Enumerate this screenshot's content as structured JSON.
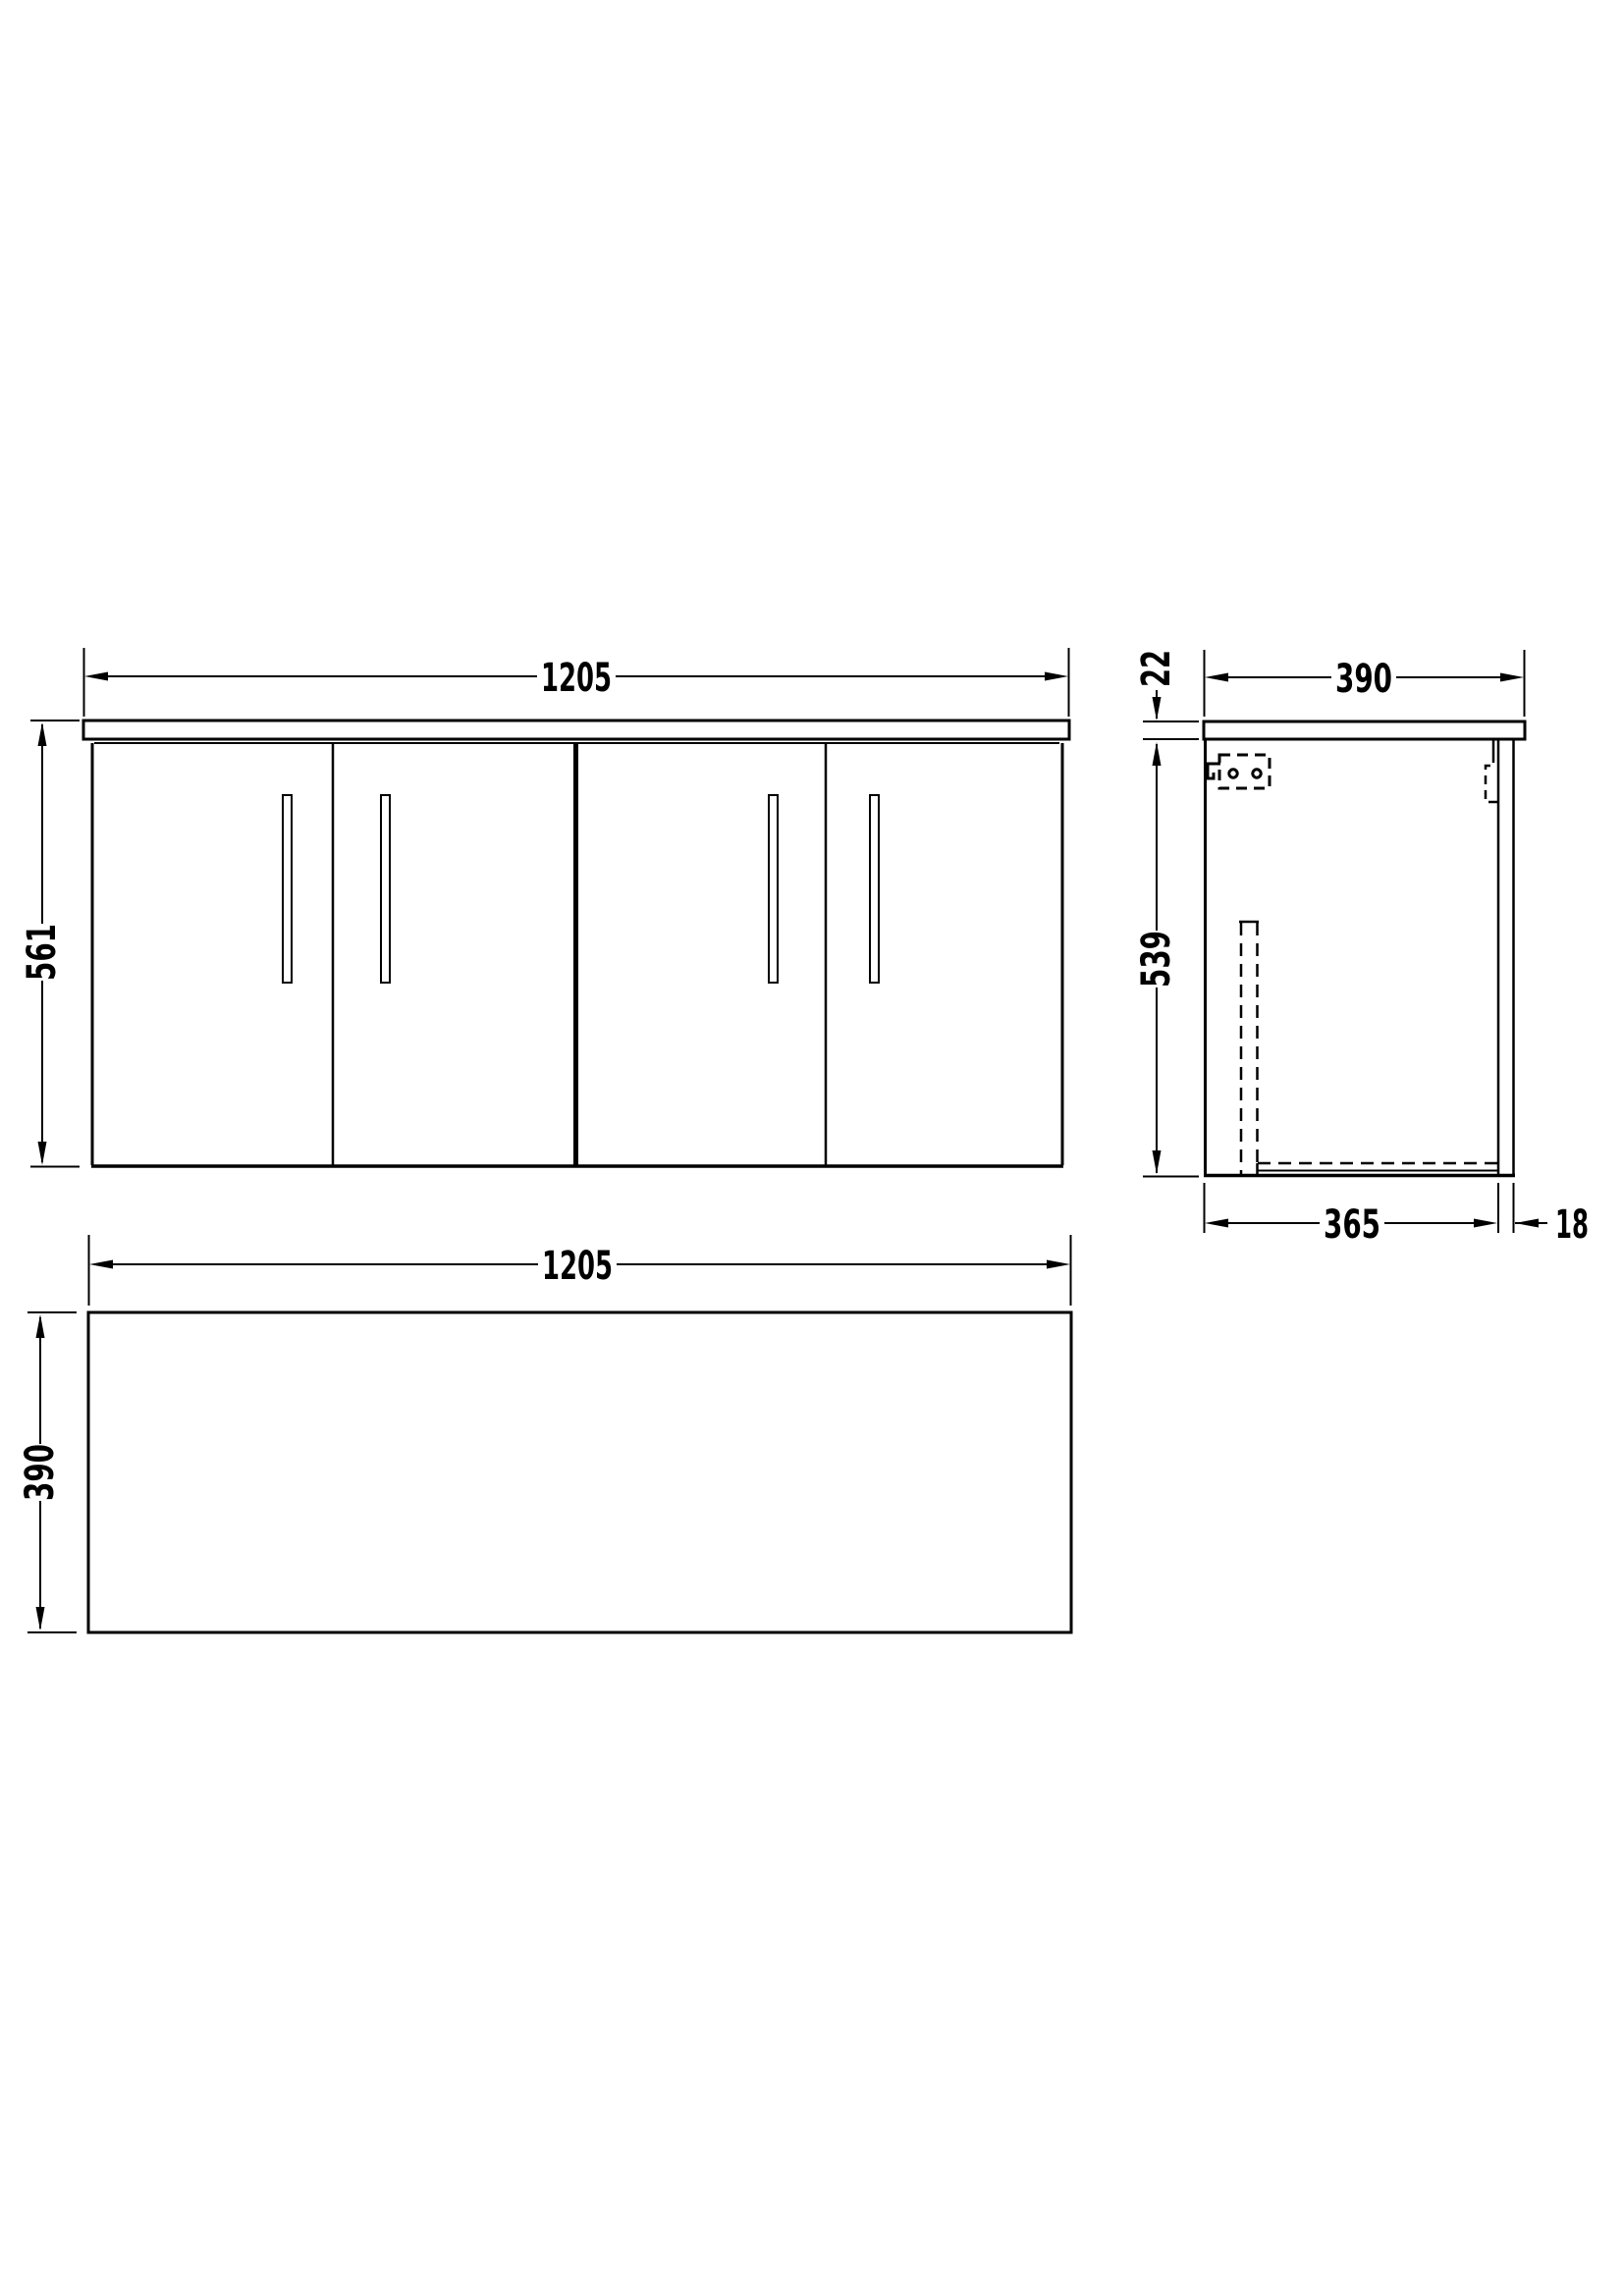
{
  "page": {
    "background": "#ffffff",
    "line_color": "#000000"
  },
  "drawing": {
    "subject": "wall-hung four-door vanity unit with worktop, three-view dimensioned technical drawing",
    "views": {
      "front": {
        "name": "front elevation",
        "width_mm": "1205",
        "height_mm": "561"
      },
      "side": {
        "name": "side section",
        "worktop_thickness_mm": "22",
        "depth_mm": "390",
        "carcass_height_mm": "539",
        "carcass_depth_mm": "365",
        "back_panel_mm": "18"
      },
      "plan": {
        "name": "plan view",
        "width_mm": "1205",
        "depth_mm": "390"
      }
    }
  }
}
